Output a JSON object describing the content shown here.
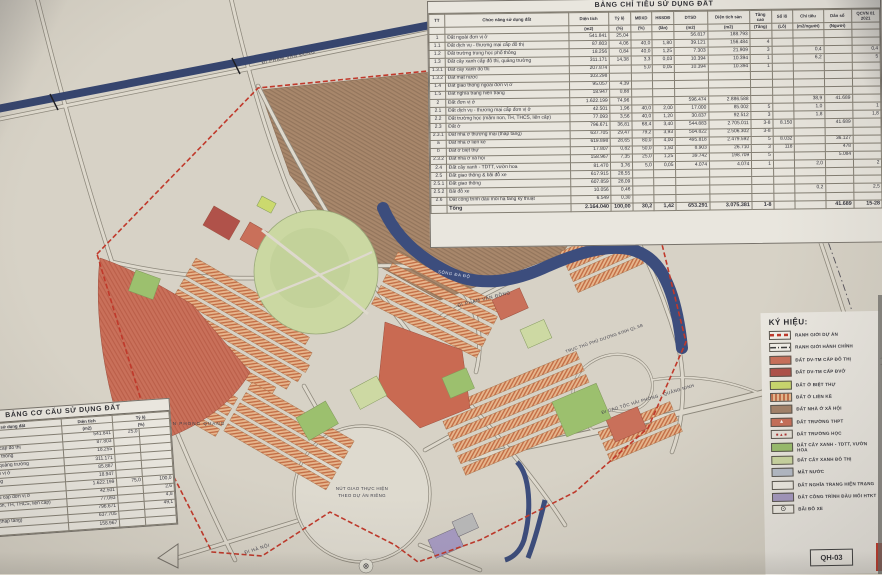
{
  "sheet": {
    "code": "QH-03"
  },
  "top_table": {
    "title": "BẢNG CHỈ TIÊU SỬ DỤNG ĐẤT",
    "col_headers": [
      "TT",
      "Chức năng sử dụng đất",
      "Diện tích",
      "Tỷ lệ",
      "MĐXD",
      "HSSDĐ",
      "DTSD",
      "Diện tích sàn",
      "Tầng cao",
      "Số lô",
      "Chỉ tiêu",
      "Dân số",
      "QCVN 01 2021"
    ],
    "col_units": [
      "",
      "",
      "(m2)",
      "(%)",
      "(%)",
      "(lần)",
      "(m2)",
      "(m2)",
      "(Tầng)",
      "(Lô)",
      "(m2/người)",
      "(Người)",
      ""
    ],
    "rows": [
      [
        "1",
        "Đất ngoài đơn vị ở",
        "541.841",
        "25,04",
        "",
        "",
        "56.817",
        "188.793",
        "",
        "",
        "",
        "",
        ""
      ],
      [
        "1.1",
        "Đất dịch vụ - thương mại cấp đô thị",
        "87.803",
        "4,06",
        "40,0",
        "1,80",
        "39.121",
        "156.484",
        "4",
        "",
        "",
        "",
        ""
      ],
      [
        "1.2",
        "Đất trường trung học phổ thông",
        "18.256",
        "0,84",
        "40,0",
        "1,25",
        "7.303",
        "21.909",
        "3",
        "",
        "0,4",
        "",
        "0,4"
      ],
      [
        "1.3",
        "Đất cây xanh cấp đô thị, quảng trường",
        "311.171",
        "14,38",
        "3,3",
        "0,03",
        "10.394",
        "10.394",
        "1",
        "",
        "6,2",
        "",
        "5"
      ],
      [
        "1.3.1",
        "Đất cây xanh đô thị",
        "207.874",
        "",
        "5,0",
        "0,05",
        "10.394",
        "10.394",
        "1",
        "",
        "",
        "",
        ""
      ],
      [
        "1.3.2",
        "Đất mặt nước",
        "103.298",
        "",
        "",
        "",
        "",
        "",
        "",
        "",
        "",
        "",
        ""
      ],
      [
        "1.4",
        "Đất giao thông ngoài đơn vị ở",
        "95.057",
        "4,39",
        "",
        "",
        "",
        "",
        "",
        "",
        "",
        "",
        ""
      ],
      [
        "1.5",
        "Đất nghĩa trang hiện trạng",
        "18.947",
        "0,88",
        "",
        "",
        "",
        "",
        "",
        "",
        "",
        "",
        ""
      ],
      [
        "2",
        "Đất đơn vị ở",
        "1.622.199",
        "74,96",
        "",
        "",
        "596.474",
        "2.886.588",
        "",
        "",
        "38,9",
        "41.689",
        ""
      ],
      [
        "2.1",
        "Đất dịch vụ - thương mại cấp đơn vị ở",
        "42.501",
        "1,96",
        "40,0",
        "2,00",
        "17.000",
        "85.002",
        "5",
        "",
        "1,0",
        "",
        "1"
      ],
      [
        "2.2",
        "Đất trường học (mầm non, TH, THCS, liên cấp)",
        "77.093",
        "3,56",
        "40,0",
        "1,20",
        "30.837",
        "92.512",
        "3",
        "",
        "1,8",
        "",
        "1,8"
      ],
      [
        "2.3",
        "Đất ở",
        "796.671",
        "36,81",
        "68,4",
        "3,40",
        "544.883",
        "2.705.011",
        "3-8",
        "8.150",
        "",
        "41.689",
        ""
      ],
      [
        "2.3.1",
        "Đất nhà ở thương mại (thấp tầng)",
        "637.705",
        "29,47",
        "79,2",
        "3,93",
        "504.822",
        "2.506.302",
        "3-8",
        "",
        "",
        "",
        ""
      ],
      [
        "a",
        "Đất nhà ở liền kề",
        "619.898",
        "28,65",
        "80,0",
        "4,00",
        "495.818",
        "2.479.592",
        "5",
        "8.032",
        "",
        "36.127",
        ""
      ],
      [
        "b",
        "Đất ở biệt thự",
        "17.807",
        "0,82",
        "50,0",
        "1,50",
        "8.903",
        "26.710",
        "3",
        "118",
        "",
        "478",
        ""
      ],
      [
        "2.3.2",
        "Đất nhà ở xã hội",
        "158.967",
        "7,35",
        "25,0",
        "1,25",
        "39.742",
        "198.709",
        "5",
        "",
        "",
        "5.084",
        ""
      ],
      [
        "2.4",
        "Đất cây xanh - TDTT, vườn hoa",
        "81.470",
        "3,76",
        "5,0",
        "0,05",
        "4.074",
        "4.074",
        "1",
        "",
        "2,0",
        "",
        "2"
      ],
      [
        "2.5",
        "Đất giao thông & bãi đỗ xe",
        "617.915",
        "28,55",
        "",
        "",
        "",
        "",
        "",
        "",
        "",
        "",
        ""
      ],
      [
        "2.5.1",
        "Đất giao thông",
        "607.859",
        "28,09",
        "",
        "",
        "",
        "",
        "",
        "",
        "",
        "",
        ""
      ],
      [
        "2.5.2",
        "Bãi đỗ xe",
        "10.056",
        "0,46",
        "",
        "",
        "",
        "",
        "",
        "",
        "0,2",
        "",
        "2,5"
      ],
      [
        "2.6",
        "Đất công trình đầu mối hạ tầng kỹ thuật",
        "6.549",
        "0,30",
        "",
        "",
        "",
        "",
        "",
        "",
        "",
        "",
        ""
      ]
    ],
    "total": [
      "",
      "Tổng",
      "2.164.040",
      "100,00",
      "30,2",
      "1,42",
      "653.291",
      "3.075.381",
      "1-8",
      "",
      "",
      "41.689",
      "15-28"
    ]
  },
  "structure_table": {
    "title": "BẢNG CƠ CẤU SỬ DỤNG ĐẤT",
    "col_headers": [
      "Chức năng sử dụng đất",
      "Diện tích",
      "Tỷ lệ"
    ],
    "col_units": [
      "",
      "(m2)",
      "(%)"
    ],
    "rows": [
      [
        "Đất ngoài đơn vị ở",
        "541.841",
        "25,0",
        ""
      ],
      [
        "Đất dịch vụ - thương mại cấp đô thị",
        "87.803",
        "",
        ""
      ],
      [
        "Đất trường trung học phổ thông",
        "18.255",
        "",
        ""
      ],
      [
        "Đất cây xanh cấp đô thị, quảng trường",
        "311.171",
        "",
        ""
      ],
      [
        "Đất giao thông ngoài đơn vị ở",
        "85.887",
        "",
        ""
      ],
      [
        "Đất nghĩa trang hiện trạng",
        "18.947",
        "",
        ""
      ],
      [
        "Đất đơn vị ở",
        "1.622.199",
        "75,0",
        "100,0"
      ],
      [
        "Đất dịch vụ - thương mại cấp đơn vị ở",
        "42.501",
        "",
        "2,6"
      ],
      [
        "Đất trường học (mầm non, TH, THCS, liên cấp)",
        "77.093",
        "",
        "4,8"
      ],
      [
        "Đất ở",
        "796.671",
        "",
        "49,1"
      ],
      [
        "Đất nhà ở thương mại (thấp tầng)",
        "637.705",
        "",
        ""
      ],
      [
        "Đất nhà ở xã hội",
        "158.967",
        "",
        ""
      ]
    ]
  },
  "legend": {
    "title": "KÝ HIỆU:",
    "items": [
      {
        "label": "RANH GIỚI DỰ ÁN",
        "swatch": "dashed-red-line",
        "glyph": ""
      },
      {
        "label": "RANH GIỚI HÀNH CHÍNH",
        "swatch": "dashdot-line",
        "glyph": ""
      },
      {
        "label": "ĐẤT DV-TM CẤP ĐÔ THỊ",
        "swatch": "salmon",
        "glyph": ""
      },
      {
        "label": "ĐẤT DV-TM CẤP ĐVỞ",
        "swatch": "darkred",
        "glyph": ""
      },
      {
        "label": "ĐẤT Ở BIỆT THỰ",
        "swatch": "yellowgreen",
        "glyph": ""
      },
      {
        "label": "ĐẤT Ở LIỀN KỀ",
        "swatch": "orange-stripes",
        "glyph": ""
      },
      {
        "label": "ĐẤT NHÀ Ở XÃ HỘI",
        "swatch": "brown",
        "glyph": ""
      },
      {
        "label": "ĐẤT TRƯỜNG THPT",
        "swatch": "school-thpt",
        "glyph": "▲"
      },
      {
        "label": "ĐẤT TRƯỜNG HỌC",
        "swatch": "school",
        "glyph": "■▲■"
      },
      {
        "label": "ĐẤT CÂY XANH - TDTT, VƯỜN HOA",
        "swatch": "green",
        "glyph": ""
      },
      {
        "label": "ĐẤT CÂY XANH ĐÔ THỊ",
        "swatch": "lightgreen",
        "glyph": ""
      },
      {
        "label": "MẶT NƯỚC",
        "swatch": "watergray",
        "glyph": ""
      },
      {
        "label": "ĐẤT NGHĨA TRANG HIỆN TRẠNG",
        "swatch": "white",
        "glyph": ""
      },
      {
        "label": "ĐẤT CÔNG TRÌNH ĐẦU MỐI HTKT",
        "swatch": "purple",
        "glyph": ""
      },
      {
        "label": "BÃI ĐỖ XE",
        "swatch": "parking",
        "glyph": "⊙"
      }
    ]
  },
  "map": {
    "labels": {
      "military": "ĐẤT QUÂN ĐỘI",
      "pham_van_dong_top": "ĐI PHẠM VĂN ĐỒNG",
      "pham_van_dong_mid": "ĐI PHẠM VĂN ĐỒNG",
      "axis_road": "TRỤC THỦ PHỦ DƯƠNG KINH QL.5B",
      "highway": "ĐI CAO TỐC HẢI PHÒNG - QUẢNG NINH",
      "interchange_line1": "NÚT GIAO THỰC HIỆN",
      "interchange_line2": "THEO DỰ ÁN RIÊNG",
      "hanoi": "ĐI HÀ NỘI",
      "village": "THÔN PHONG QUANG",
      "river": "SÔNG ĐA ĐỘ"
    }
  },
  "colors": {
    "boundary_red": "#c0392b",
    "river_navy": "#3c4d7d",
    "parcel_salmon": "#c9705a",
    "parcel_darkred": "#b0524a",
    "parcel_orange": "#e6b68d",
    "stripe_orange": "#c47048",
    "parcel_green": "#9cc06e",
    "parcel_lightgreen": "#cdd9a3",
    "parcel_brown": "#a8876b",
    "parcel_purple": "#a79bc2",
    "water_gray": "#b7bec9",
    "paper": "#d7d2c6"
  }
}
